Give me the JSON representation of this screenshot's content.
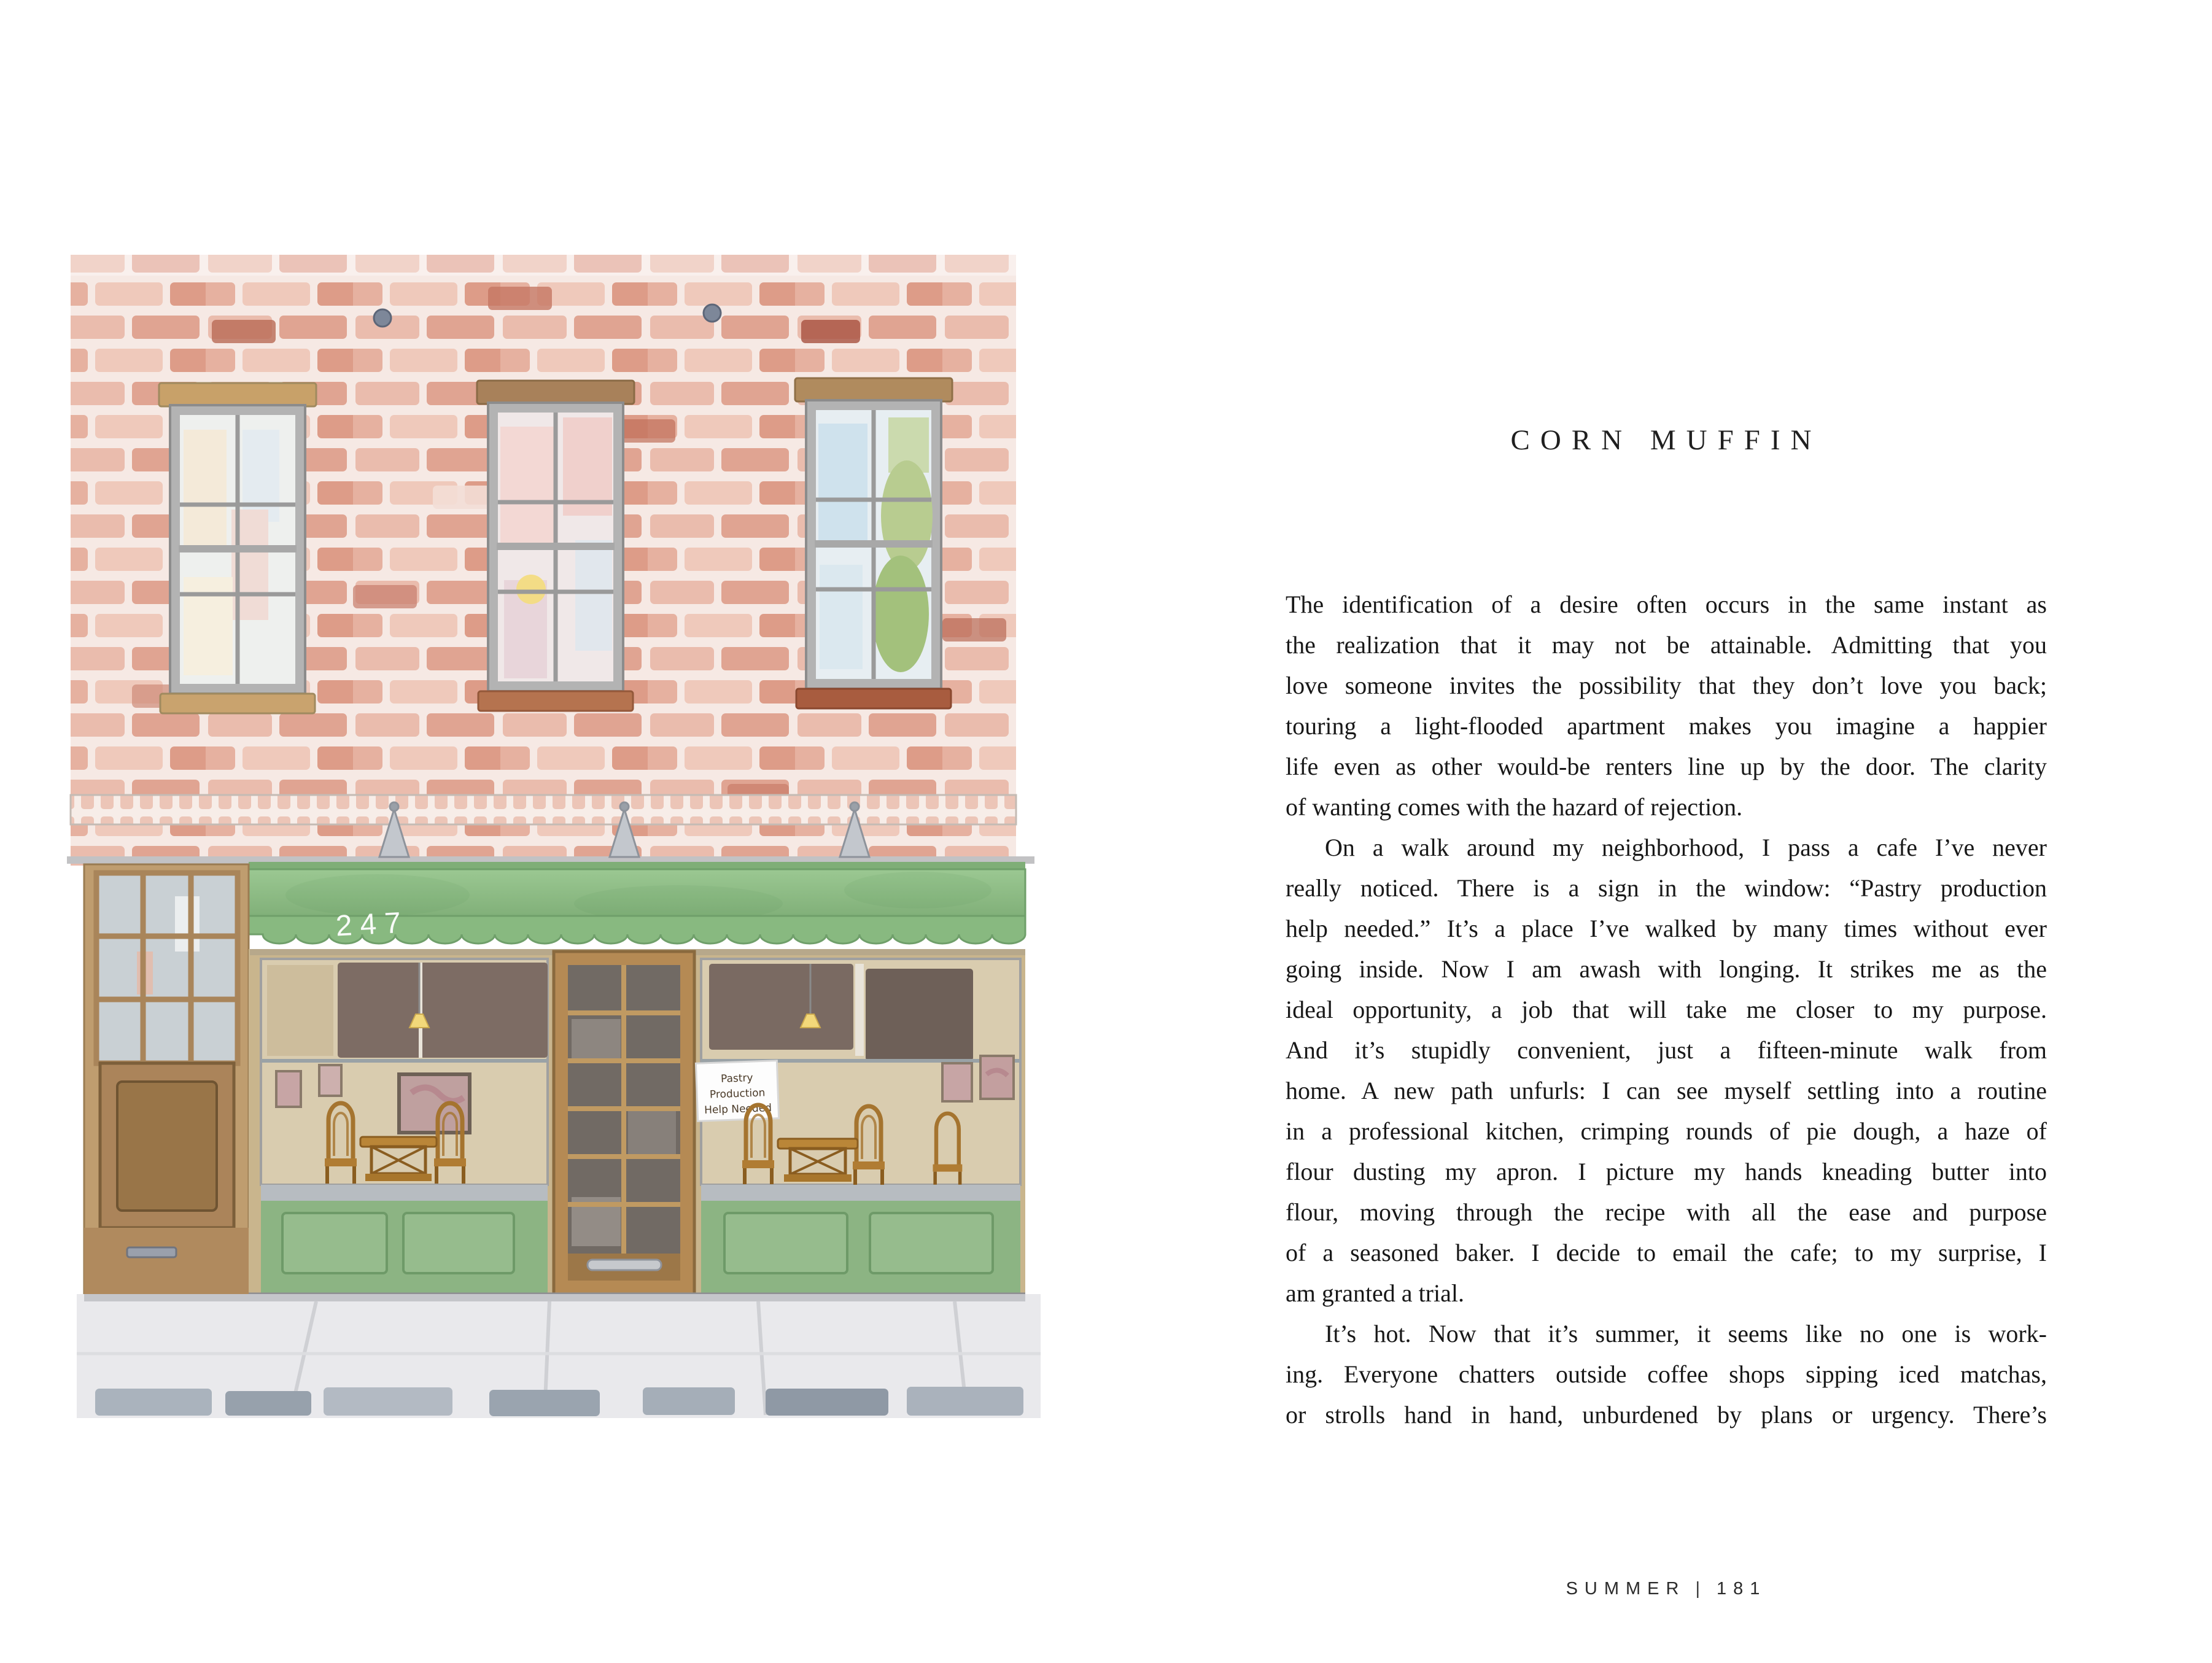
{
  "right_page": {
    "title": "CORN MUFFIN",
    "paragraphs": [
      {
        "lines": [
          "The identification of a desire often occurs in the same instant as",
          "the realization that it may not be attainable. Admitting that you",
          "love someone invites the possibility that they don’t love you back;",
          "touring a light-flooded apartment makes you imagine a happier",
          "life even as other would-be renters line up by the door. The clarity",
          "of wanting comes with the hazard of rejection."
        ]
      },
      {
        "lines": [
          "On a walk around my neighborhood, I pass a cafe I’ve never",
          "really noticed. There is a sign in the window: “Pastry production",
          "help needed.” It’s a place I’ve walked by many times without ever",
          "going inside. Now I am awash with longing. It strikes me as the",
          "ideal opportunity, a job that will take me closer to my purpose.",
          "And it’s stupidly convenient, just a fifteen-minute walk from",
          "home. A new path unfurls: I can see myself settling into a routine",
          "in a professional kitchen, crimping rounds of pie dough, a haze of",
          "flour dusting my apron. I picture my hands kneading butter into",
          "flour, moving through the recipe with all the ease and purpose",
          "of a seasoned baker. I decide to email the cafe; to my surprise, I",
          "am granted a trial."
        ]
      },
      {
        "lines": [
          "It’s hot. Now that it’s summer, it seems like no one is work-",
          "ing. Everyone chatters outside coffee shops sipping iced matchas,",
          "or strolls hand in hand, unburdened by plans or urgency. There’s"
        ]
      }
    ],
    "footer": {
      "section": "SUMMER",
      "separator": "|",
      "page_number": "181"
    }
  },
  "illustration": {
    "awning_number": "247",
    "window_sign_lines": [
      "Pastry",
      "Production",
      "Help Needed"
    ]
  },
  "palette": {
    "mortar": "#f6e9e4",
    "awning_green_light": "#9bc892",
    "awning_green_dark": "#7fae77",
    "valance_green": "#88b980",
    "wainscot_green": "#8cb483",
    "interior_beige": "#d9ccaf",
    "wood_tan": "#b58a54",
    "sidewalk_gray": "#e9e9ec",
    "ink": "#1c1c1c"
  }
}
